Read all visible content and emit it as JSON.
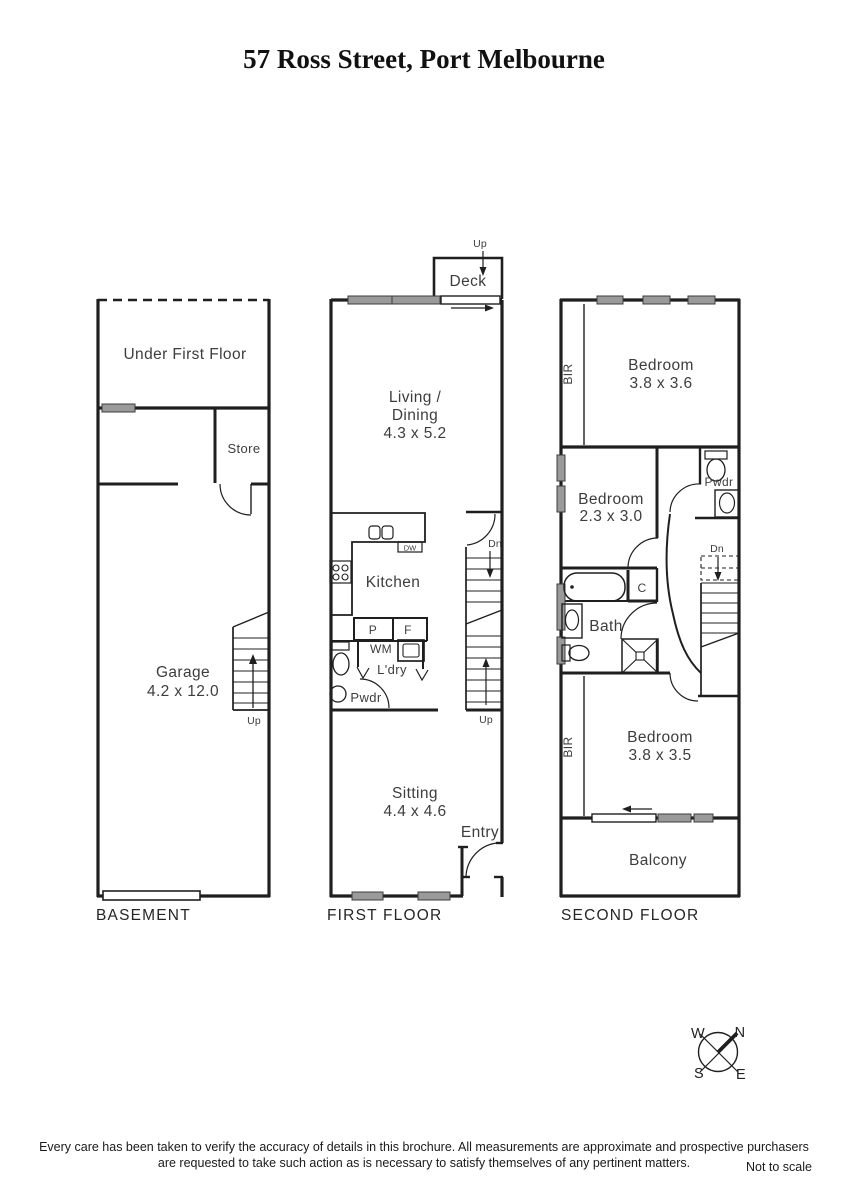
{
  "title": "57 Ross Street, Port Melbourne",
  "colors": {
    "wall": "#1f1f1f",
    "window_fill": "#9a9a9a",
    "label_text": "#3d3d3d"
  },
  "floors": {
    "basement": {
      "label": "BASEMENT",
      "under_first_floor": "Under First Floor",
      "store": "Store",
      "garage_name": "Garage",
      "garage_dims": "4.2 x 12.0",
      "stairs_up": "Up"
    },
    "first": {
      "label": "FIRST FLOOR",
      "deck": "Deck",
      "deck_up": "Up",
      "living_line1": "Living /",
      "living_line2": "Dining",
      "living_dims": "4.3 x 5.2",
      "kitchen": "Kitchen",
      "dishwasher": "DW",
      "pantry": "P",
      "fridge": "F",
      "washing_machine": "WM",
      "laundry": "L'dry",
      "powder": "Pwdr",
      "stairs_dn": "Dn",
      "stairs_up": "Up",
      "sitting_name": "Sitting",
      "sitting_dims": "4.4 x 4.6",
      "entry": "Entry"
    },
    "second": {
      "label": "SECOND FLOOR",
      "bir_top": "BIR",
      "bed1_name": "Bedroom",
      "bed1_dims": "3.8 x 3.6",
      "bed2_name": "Bedroom",
      "bed2_dims": "2.3 x 3.0",
      "powder": "Pwdr",
      "cupboard": "C",
      "bath": "Bath",
      "stairs_dn": "Dn",
      "bir_bottom": "BIR",
      "bed3_name": "Bedroom",
      "bed3_dims": "3.8 x 3.5",
      "balcony": "Balcony"
    }
  },
  "compass": {
    "north": "N",
    "south": "S",
    "east": "E",
    "west": "W"
  },
  "footer": {
    "disclaimer_line1": "Every care has been taken to verify the accuracy of details in this brochure.  All measurements are approximate and prospective purchasers",
    "disclaimer_line2": "are requested to take such action as is necessary to satisfy themselves of any pertinent matters.",
    "scale_note": "Not to scale"
  }
}
